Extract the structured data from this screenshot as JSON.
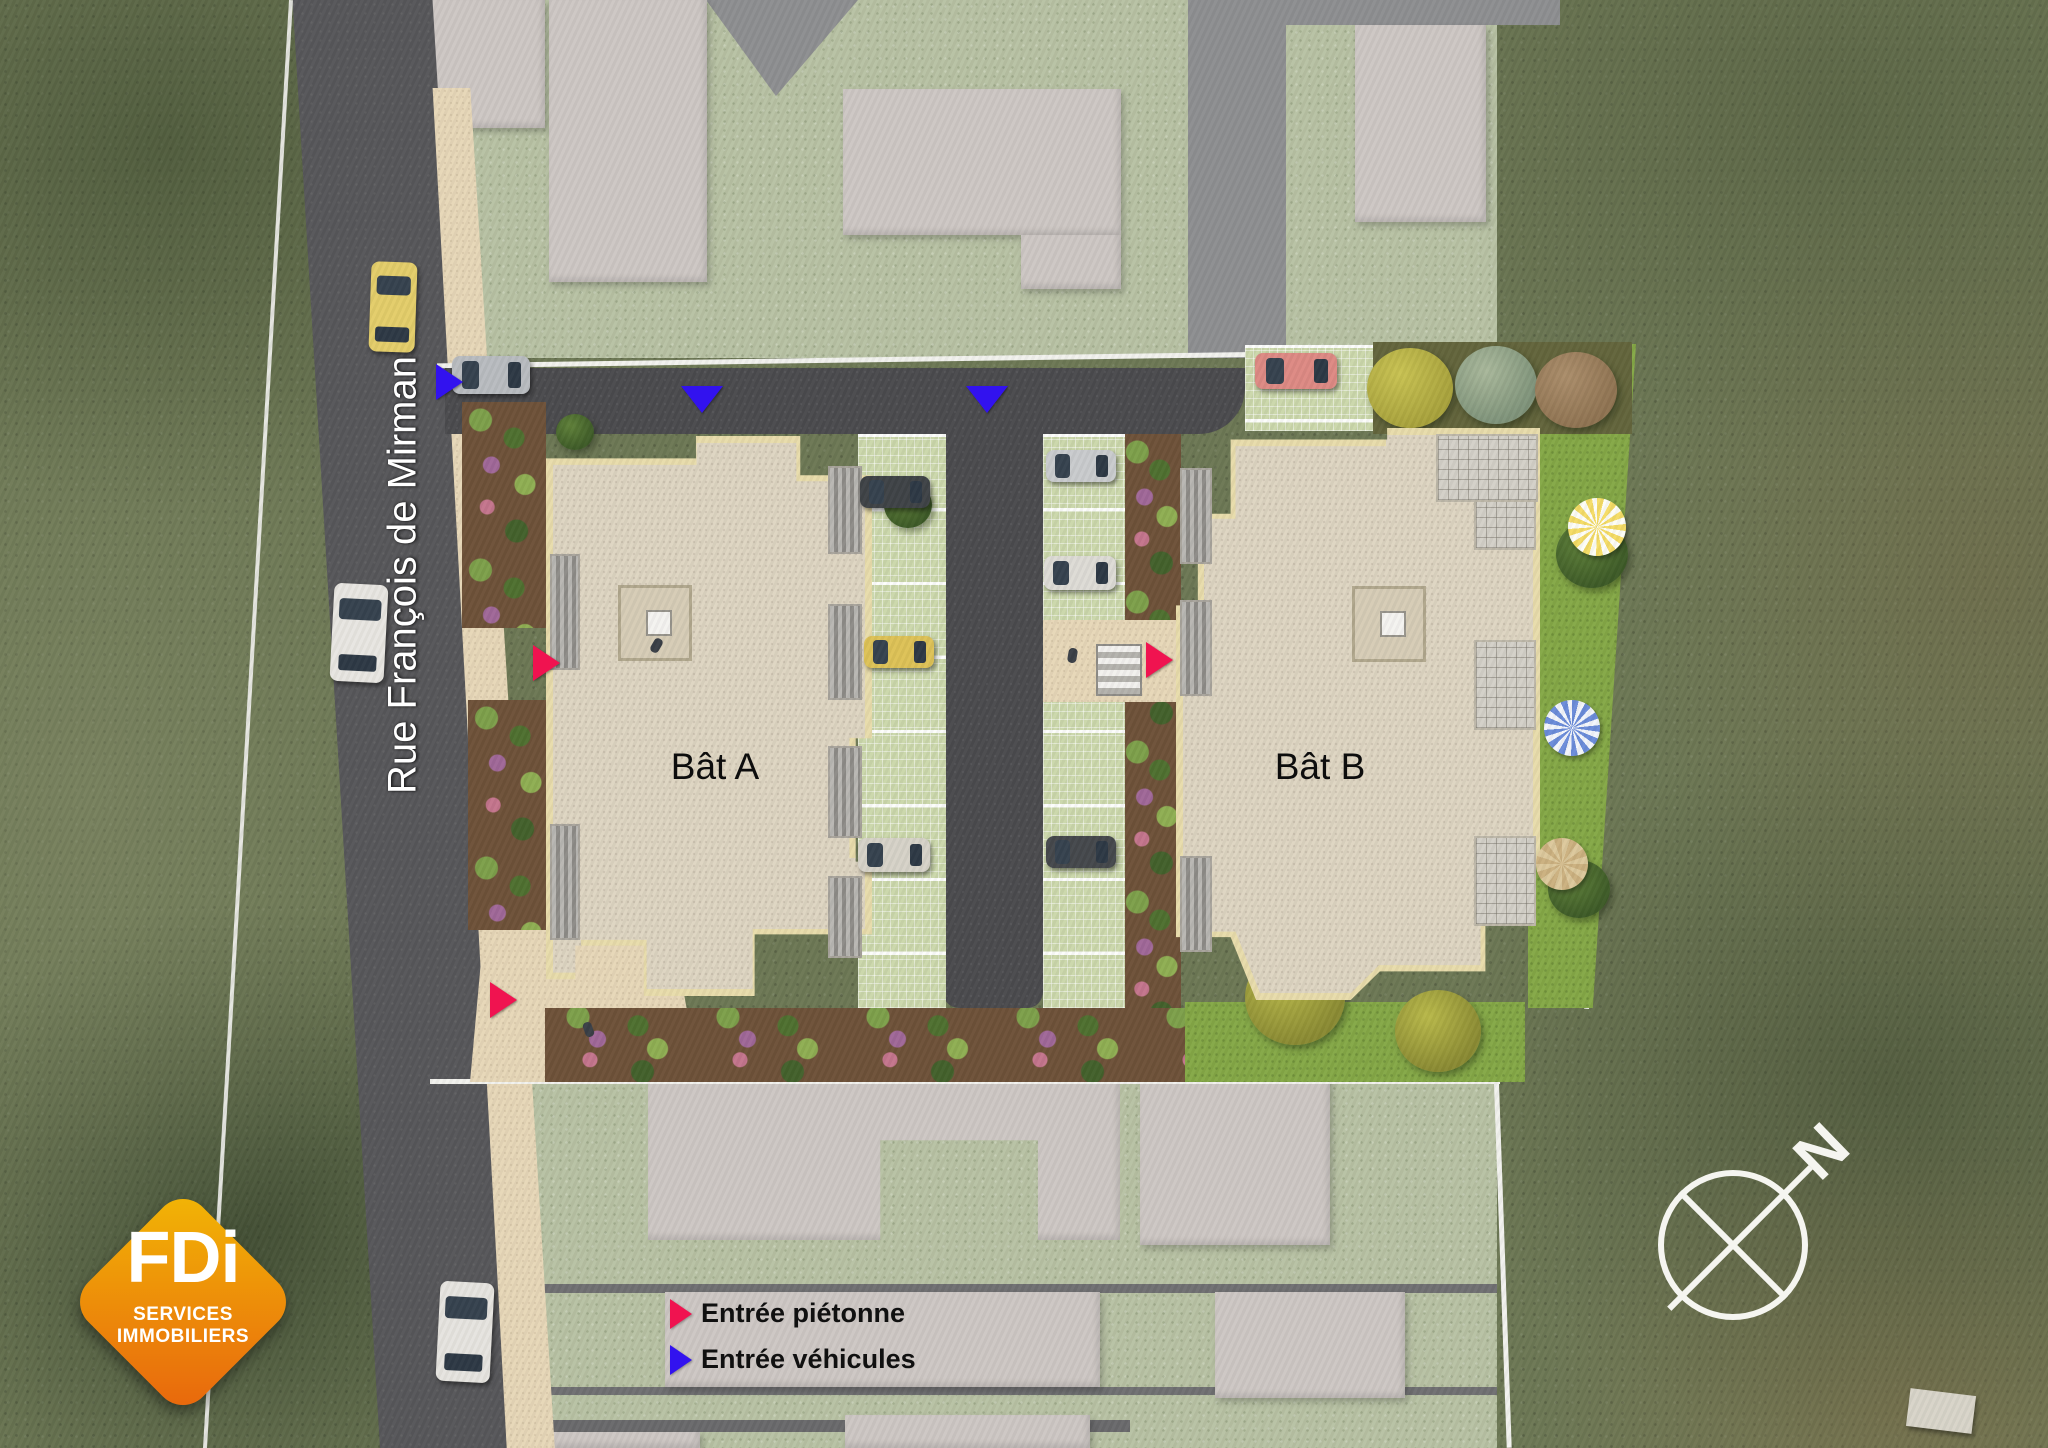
{
  "street": {
    "name": "Rue François de Mirman"
  },
  "buildings": [
    {
      "id": "bat-a",
      "label": "Bât A"
    },
    {
      "id": "bat-b",
      "label": "Bât B"
    }
  ],
  "legend": {
    "items": [
      {
        "label": "Entrée piétonne",
        "marker": "arrow-right",
        "color": "#f01350"
      },
      {
        "label": "Entrée véhicules",
        "marker": "arrow-right",
        "color": "#3212ef"
      }
    ]
  },
  "map_markers": {
    "pedestrian_color": "#f01350",
    "vehicle_color": "#3212ef",
    "pedestrian_entries": [
      {
        "x": 533,
        "y": 645
      },
      {
        "x": 1146,
        "y": 642
      },
      {
        "x": 490,
        "y": 982
      }
    ],
    "vehicle_entries": [
      {
        "x": 436,
        "y": 364,
        "dir": "right"
      },
      {
        "x": 681,
        "y": 386,
        "dir": "down"
      },
      {
        "x": 966,
        "y": 386,
        "dir": "down"
      }
    ]
  },
  "logo": {
    "brand": "FDi",
    "tagline1": "SERVICES",
    "tagline2": "IMMOBILIERS",
    "gradient_from": "#f2b705",
    "gradient_to": "#e8650d"
  },
  "compass": {
    "label": "N"
  }
}
